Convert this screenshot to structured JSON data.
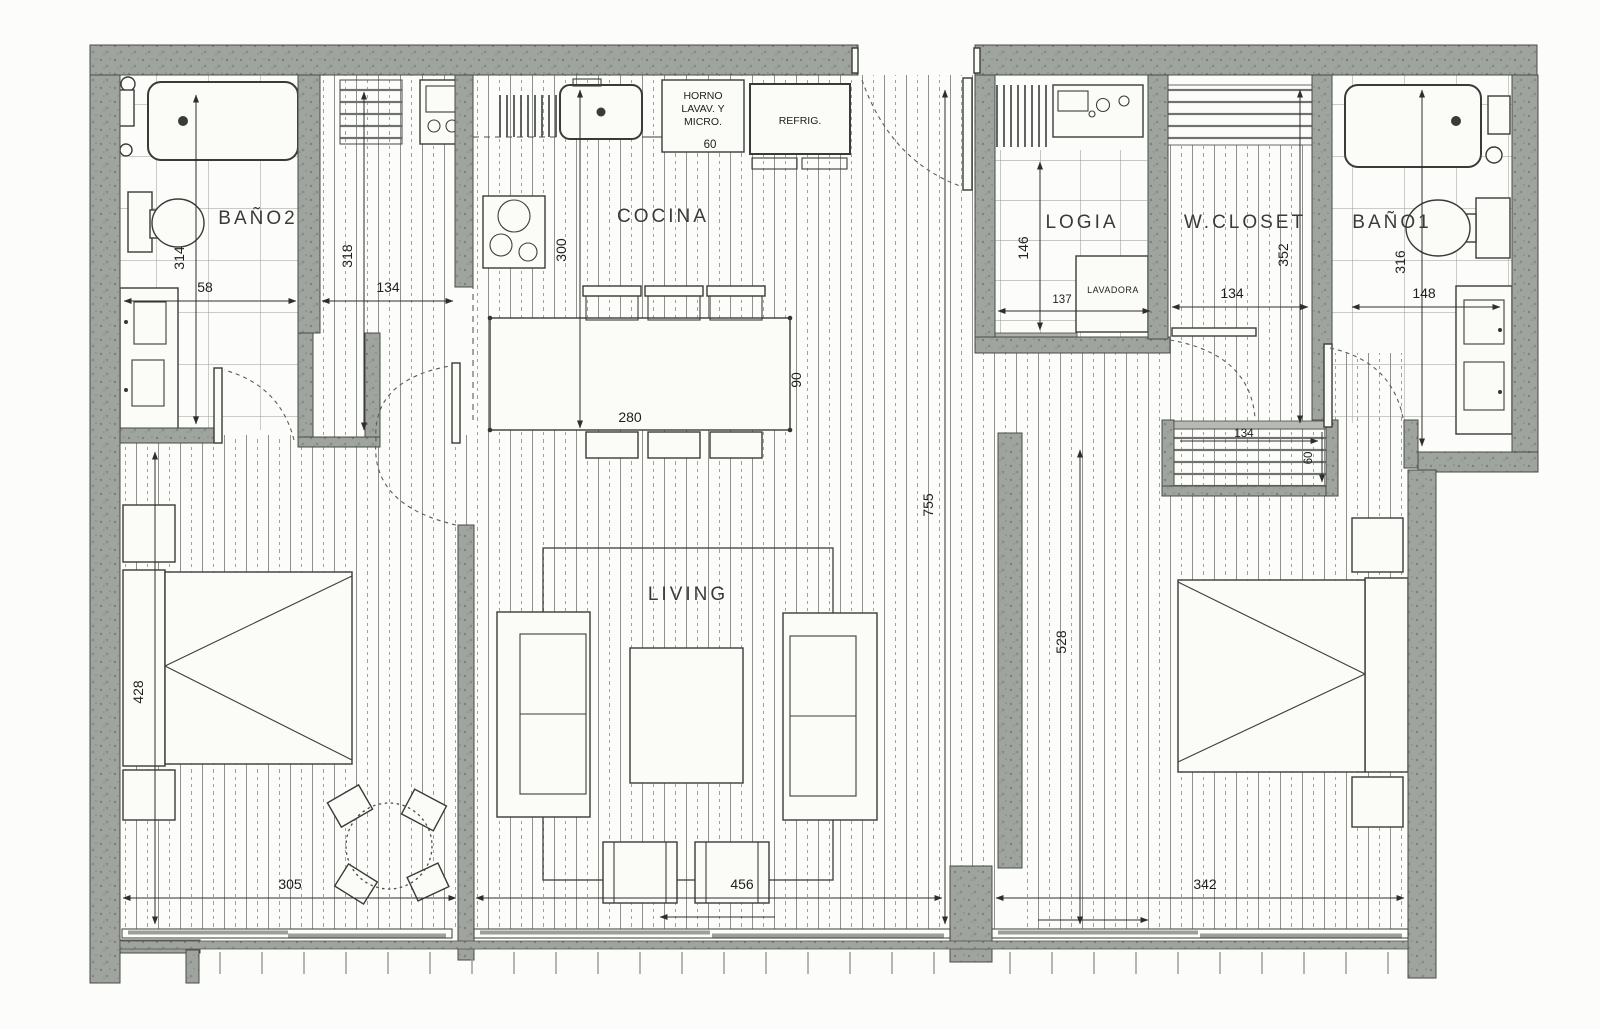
{
  "rooms": {
    "bano2": "BAÑO2",
    "cocina": "COCINA",
    "logia": "LOGIA",
    "wcloset": "W.CLOSET",
    "bano1": "BAÑO1",
    "living": "LIVING"
  },
  "appliances": {
    "horno_l1": "HORNO",
    "horno_l2": "LAVAV. Y",
    "horno_l3": "MICRO.",
    "refrig": "REFRIG.",
    "lavadora": "LAVADORA"
  },
  "dims": {
    "bano2_w": "58",
    "bano2_h": "314",
    "hall_w": "134",
    "hall_h": "318",
    "cocina_h": "300",
    "horno_w": "60",
    "island_w": "280",
    "island_d": "90",
    "logia_h": "146",
    "logia_w": "137",
    "wcloset_w": "134",
    "wcloset_h": "352",
    "bano1_h": "316",
    "bano1_w": "148",
    "bed1_h": "428",
    "bed1_w": "305",
    "living_w": "456",
    "depth_total": "755",
    "bed2_h": "528",
    "bed2_w": "342",
    "closet2_w": "134",
    "closet2_d": "60"
  },
  "colors": {
    "wall": "#a0a49e",
    "line": "#3a3a38",
    "paper": "#fcfcfa"
  }
}
